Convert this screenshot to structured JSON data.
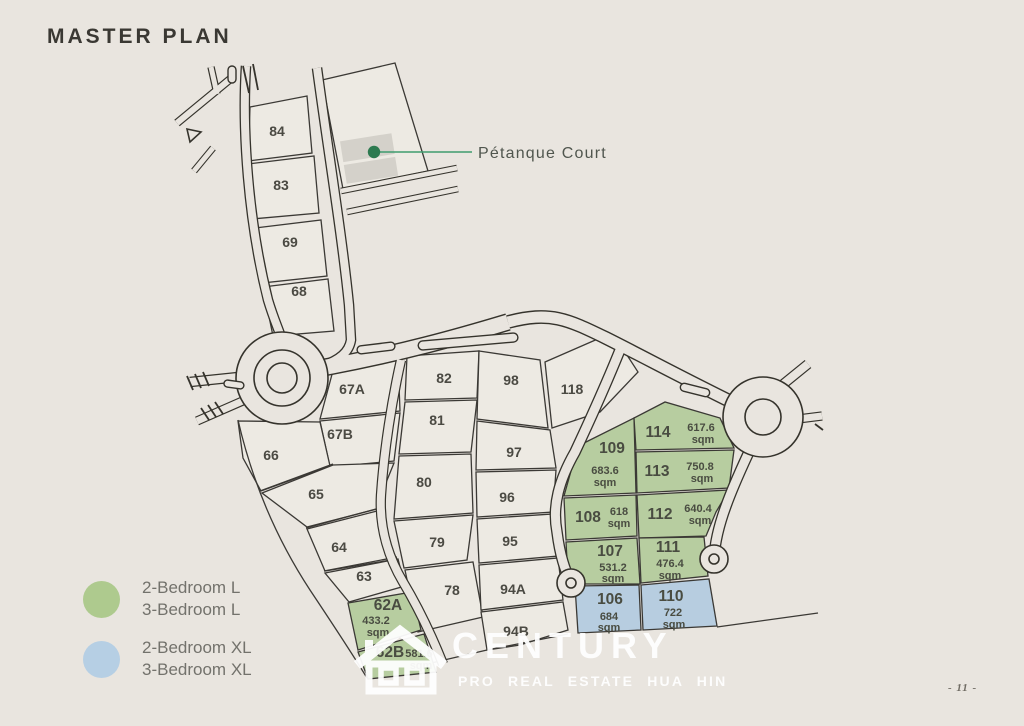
{
  "page": {
    "title": "MASTER PLAN",
    "page_number": "- 11 -"
  },
  "colors": {
    "background": "#e9e5df",
    "lot_fill": "#edeae3",
    "line": "#3b3935",
    "lot_green": "#b7cda0",
    "lot_blue": "#b7cde0",
    "legend_green": "#aeca8e",
    "legend_blue": "#b6cfe4",
    "petanque_dot": "#2d7a50",
    "petanque_line": "#3f9c6e",
    "court_gray": "#d4d1ca",
    "watermark": "#ffffff"
  },
  "annotation": {
    "petanque_label": "Pétanque Court"
  },
  "legend": {
    "items": [
      {
        "line1": "2-Bedroom L",
        "line2": "3-Bedroom L"
      },
      {
        "line1": "2-Bedroom XL",
        "line2": "3-Bedroom XL"
      }
    ]
  },
  "watermark": {
    "brand": "CENTURY",
    "tagline": "PRO REAL ESTATE HUA HIN"
  },
  "lots": [
    {
      "number": "84"
    },
    {
      "number": "83"
    },
    {
      "number": "69"
    },
    {
      "number": "68"
    },
    {
      "number": "67A"
    },
    {
      "number": "67B"
    },
    {
      "number": "66"
    },
    {
      "number": "65"
    },
    {
      "number": "64"
    },
    {
      "number": "63"
    },
    {
      "number": "62A",
      "area_value": "433.2",
      "area_unit": "sqm"
    },
    {
      "number": "62B",
      "area_value": "581.6",
      "area_unit": "sqm"
    },
    {
      "number": "82"
    },
    {
      "number": "81"
    },
    {
      "number": "80"
    },
    {
      "number": "79"
    },
    {
      "number": "78"
    },
    {
      "number": "98"
    },
    {
      "number": "97"
    },
    {
      "number": "96"
    },
    {
      "number": "95"
    },
    {
      "number": "94A"
    },
    {
      "number": "94B"
    },
    {
      "number": "118"
    },
    {
      "number": "109",
      "area_value": "683.6",
      "area_unit": "sqm"
    },
    {
      "number": "114",
      "area_value": "617.6",
      "area_unit": "sqm"
    },
    {
      "number": "113",
      "area_value": "750.8",
      "area_unit": "sqm"
    },
    {
      "number": "108",
      "area_value": "618",
      "area_unit": "sqm"
    },
    {
      "number": "112",
      "area_value": "640.4",
      "area_unit": "sqm"
    },
    {
      "number": "107",
      "area_value": "531.2",
      "area_unit": "sqm"
    },
    {
      "number": "111",
      "area_value": "476.4",
      "area_unit": "sqm"
    },
    {
      "number": "106",
      "area_value": "684",
      "area_unit": "sqm"
    },
    {
      "number": "110",
      "area_value": "722",
      "area_unit": "sqm"
    }
  ]
}
